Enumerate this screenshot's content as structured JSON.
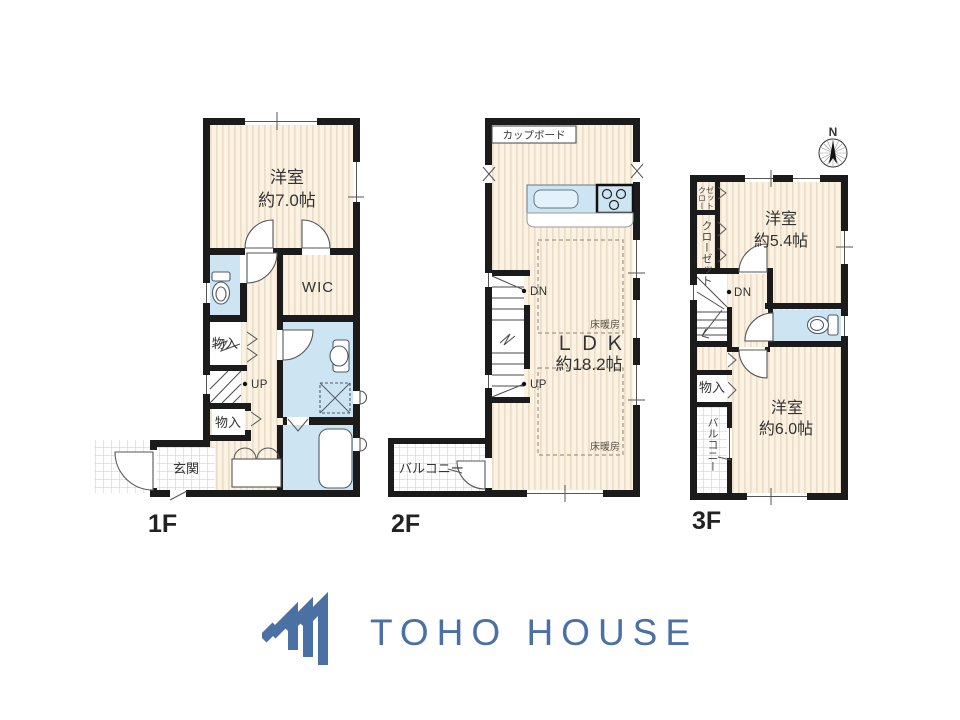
{
  "colors": {
    "wall": "#1B1B1B",
    "floor_base": "#FBF2E3",
    "floor_stripe": "#ECDEC6",
    "wet_area_blue": "#CDE4F2",
    "fixture_fill": "#E3F1FA",
    "tile_line": "#C9C9C9",
    "dashed_line": "#A39780",
    "text": "#333333",
    "logo_blue": "#4A70A4"
  },
  "floor1": {
    "label": "1F",
    "room1": "洋室",
    "room1_size": "約7.0帖",
    "wic": "WIC",
    "storage_upper": "物入",
    "storage_lower": "物入",
    "entrance": "玄関",
    "up": "UP"
  },
  "floor2": {
    "label": "2F",
    "cupboard": "カップボード",
    "ldk": "ＬＤＫ",
    "ldk_size": "約18.2帖",
    "floor_heating_upper": "床暖房",
    "floor_heating_lower": "床暖房",
    "balcony": "バルコニー",
    "dn": "DN",
    "up": "UP"
  },
  "floor3": {
    "label": "3F",
    "compass_n": "N",
    "room1": "洋室",
    "room1_size": "約5.4帖",
    "closet_small_line1": "クロー",
    "closet_small_line2": "ゼット",
    "closet": "クローゼット",
    "storage": "物入",
    "balcony": "バルコニー",
    "room2": "洋室",
    "room2_size": "約6.0帖",
    "dn": "DN"
  },
  "logo": {
    "name": "TOHO HOUSE"
  }
}
